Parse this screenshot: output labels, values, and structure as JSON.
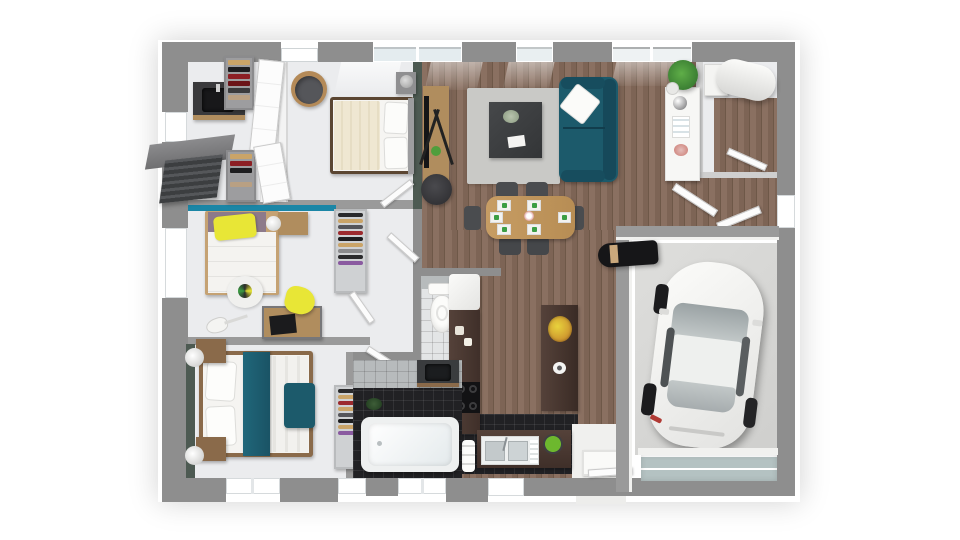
{
  "scene": {
    "kind": "3d-floorplan-top-view-render",
    "background_color": "#ffffff",
    "visible_text": "none"
  },
  "palette": {
    "exterior_wall": "#8e8e8e",
    "interior_floor_light": "#ebecee",
    "wood_floor": "#8a7061",
    "sofa_teal": "#1c5a6b",
    "accent_wall_teal": "#1b86a6",
    "accent_wall_green": "#4d5a52",
    "kitchen_cabinet_brown": "#4a3832",
    "bathroom_tile_black": "#212124",
    "garage_concrete": "#d9d9d7",
    "car_body": "#f3f3f1",
    "desk_wood": "#b08d5e",
    "kid_accent_yellow": "#e8e636"
  },
  "rooms": {
    "dressing_bathroom_nw": [
      "dark-vanity-sink",
      "wardrobe-clothes-rack",
      "wardrobe-clothes-rack",
      "white-closet-doors",
      "exterior-awning"
    ],
    "master_bedroom": [
      "double-bed-white",
      "nightstand-lamp",
      "barrel-chair",
      "closet-doors"
    ],
    "kids_bedroom": [
      "single-bed-yellow-pillow",
      "nightstand-lamp",
      "round-rug",
      "desk-laptop",
      "yellow-chair",
      "guitar",
      "wardrobe"
    ],
    "bedroom_south": [
      "double-bed-teal-throw",
      "nightstand-lamp-left-top",
      "nightstand-lamp-left-bottom",
      "teal-bench",
      "green-accent-wall"
    ],
    "living_dining": [
      "tv-console",
      "black-stool",
      "area-rug",
      "coffee-table-plant",
      "teal-sofa-white-pillow",
      "dining-table-6-settings",
      "dining-chairs",
      "white-sideboard",
      "potted-plant"
    ],
    "kitchen": [
      "fridge",
      "tall-cabinet",
      "cooktop-4-burners",
      "island-fruit-bowl",
      "double-sink-counter",
      "plant-bowl"
    ],
    "wc": [
      "toilet"
    ],
    "bathroom": [
      "bathtub",
      "dark-vanity",
      "floor-plant"
    ],
    "hallway": [
      "shoe-cabinet-north",
      "shoe-cabinet-south",
      "open-door-leaves"
    ],
    "utility_room": [
      "water-heater-cylinder",
      "wall-boiler",
      "open-door"
    ],
    "entry": [
      "doormat",
      "front-door"
    ],
    "garage": [
      "white-car",
      "black-bag",
      "garage-door"
    ]
  }
}
